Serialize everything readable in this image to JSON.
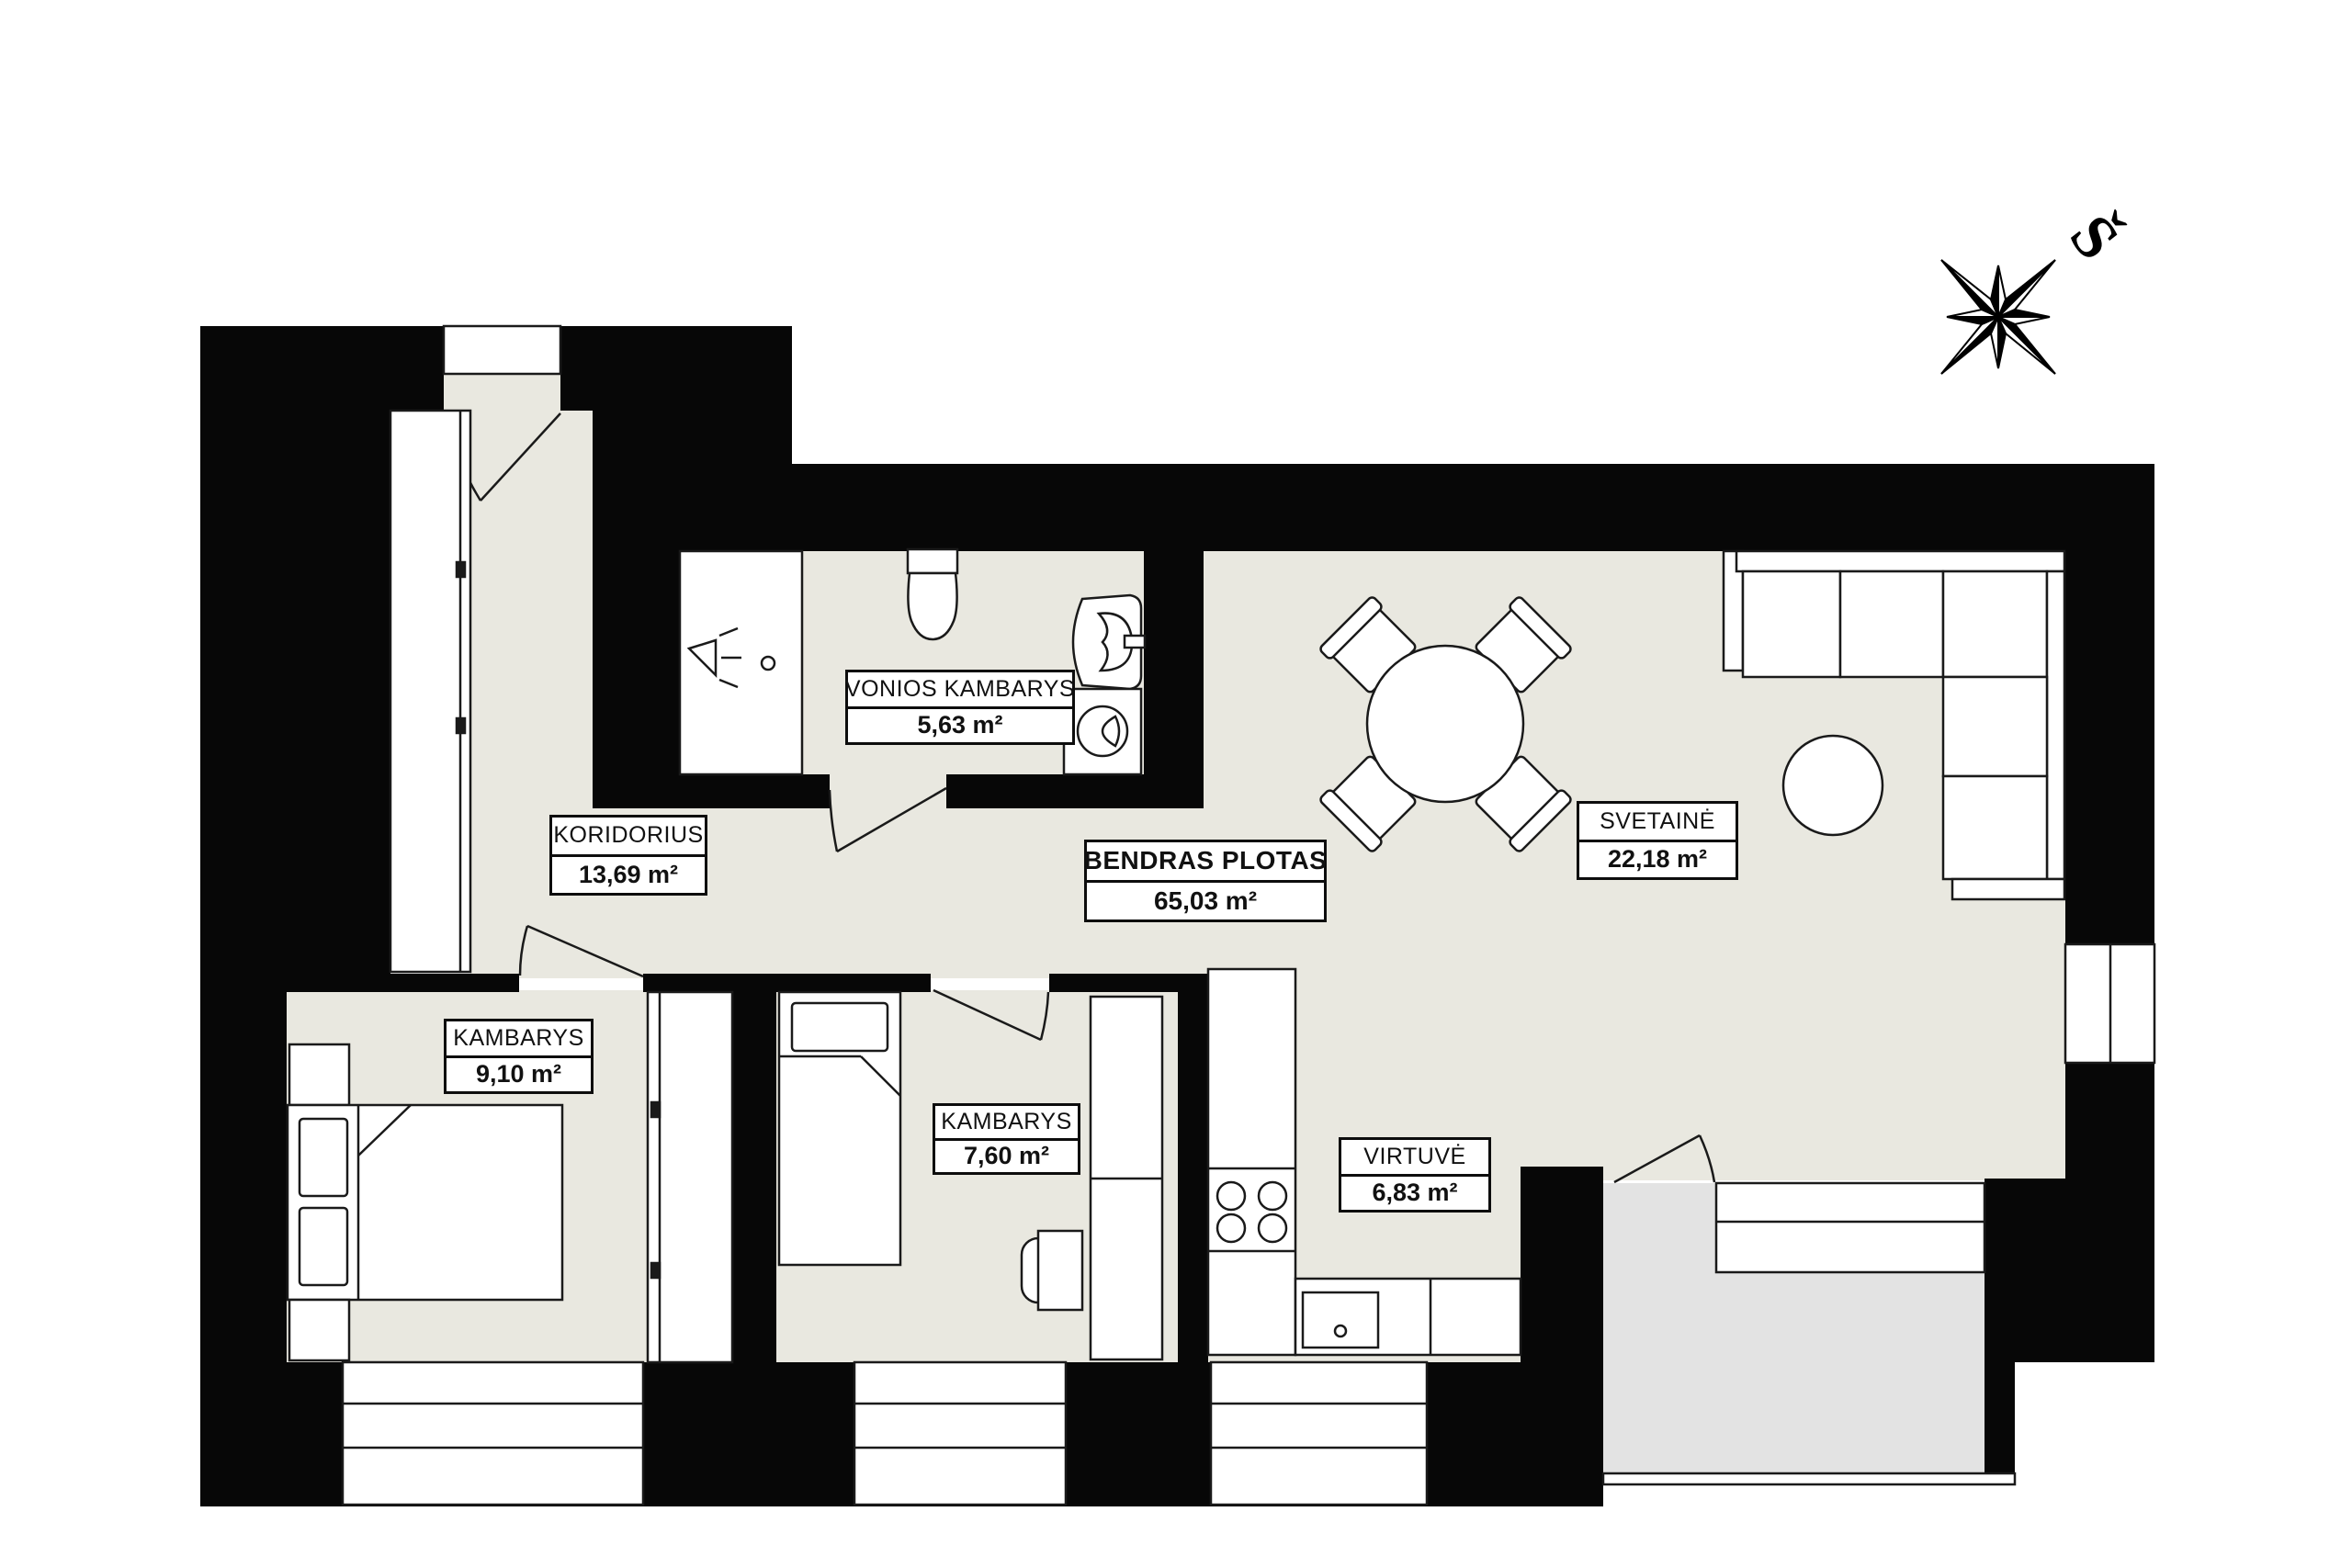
{
  "title": "Apartment floor plan",
  "compass": {
    "north_label": "Š"
  },
  "colors": {
    "wall": "#070707",
    "floor": "#e9e8e0",
    "balcony_floor": "#e3e3e3",
    "furniture_outline": "#1a1a1a",
    "label_background": "#ffffff",
    "label_border": "#0d0d0d"
  },
  "rooms": [
    {
      "id": "vonios-kambarys",
      "name": "VONIOS KAMBARYS",
      "area": "5,63 m²"
    },
    {
      "id": "koridorius",
      "name": "KORIDORIUS",
      "area": "13,69 m²"
    },
    {
      "id": "bendras-plotas",
      "name": "BENDRAS PLOTAS",
      "area": "65,03 m²"
    },
    {
      "id": "svetaine",
      "name": "SVETAINĖ",
      "area": "22,18 m²"
    },
    {
      "id": "kambarys-1",
      "name": "KAMBARYS",
      "area": "9,10 m²"
    },
    {
      "id": "kambarys-2",
      "name": "KAMBARYS",
      "area": "7,60 m²"
    },
    {
      "id": "virtuve",
      "name": "VIRTUVĖ",
      "area": "6,83 m²"
    }
  ]
}
